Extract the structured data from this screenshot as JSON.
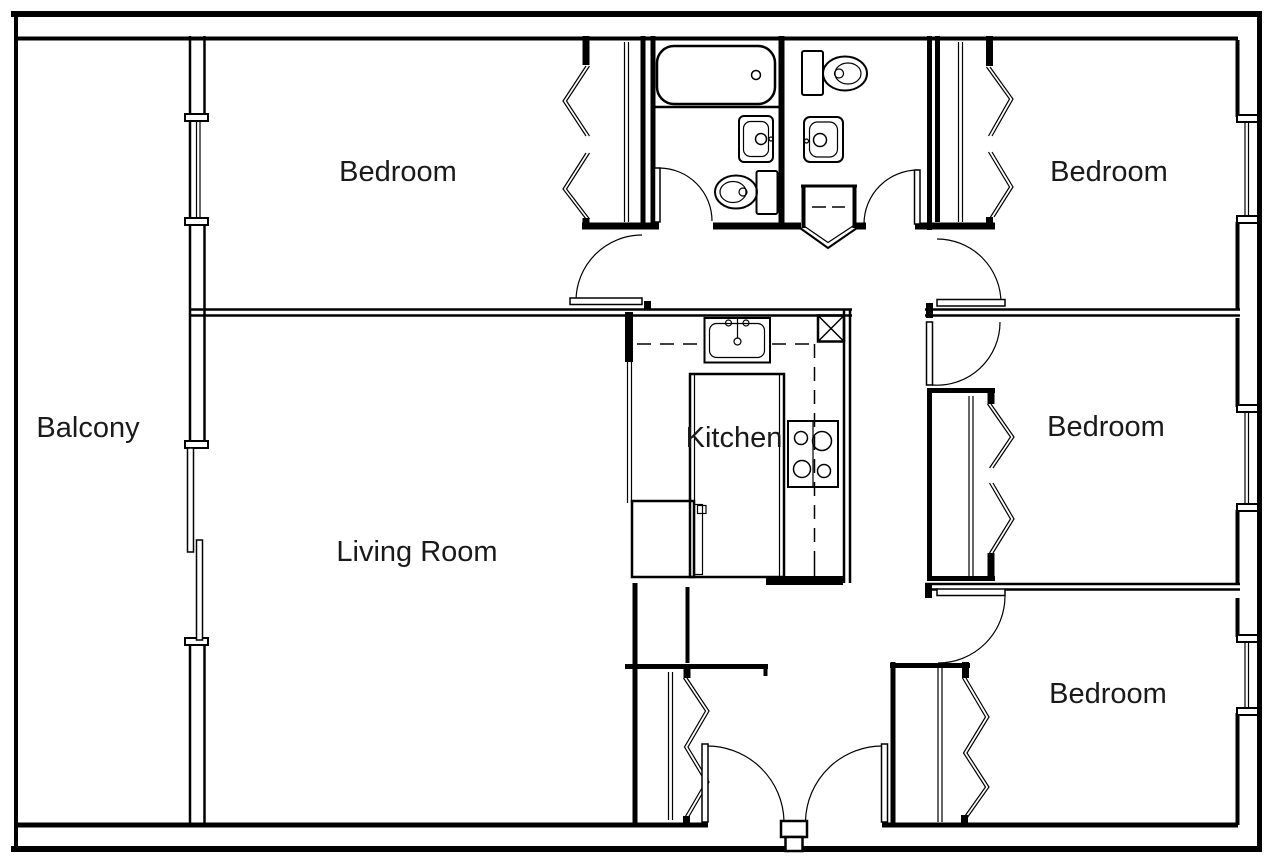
{
  "plan": {
    "type": "apartment-floor-plan",
    "colors": {
      "wall": "#000000",
      "background": "#ffffff",
      "text": "#1a1a1a"
    },
    "rooms": {
      "balcony": {
        "label": "Balcony"
      },
      "bedroom_top_left": {
        "label": "Bedroom"
      },
      "bedroom_top_right": {
        "label": "Bedroom"
      },
      "bedroom_middle_right": {
        "label": "Bedroom"
      },
      "bedroom_bottom_right": {
        "label": "Bedroom"
      },
      "living_room": {
        "label": "Living Room"
      },
      "kitchen": {
        "label": "Kitchen"
      }
    },
    "fixtures": [
      "bathtub",
      "toilet",
      "toilet",
      "bathroom-sink",
      "bathroom-sink",
      "corner-shower",
      "kitchen-sink",
      "stove-cooktop",
      "refrigerator",
      "kitchen-peninsula",
      "vent-shaft",
      "sliding-balcony-door",
      "window",
      "window",
      "window",
      "window",
      "bifold-closet",
      "bifold-closet",
      "bifold-closet",
      "bifold-closet",
      "bifold-closet",
      "double-entry-door"
    ]
  }
}
